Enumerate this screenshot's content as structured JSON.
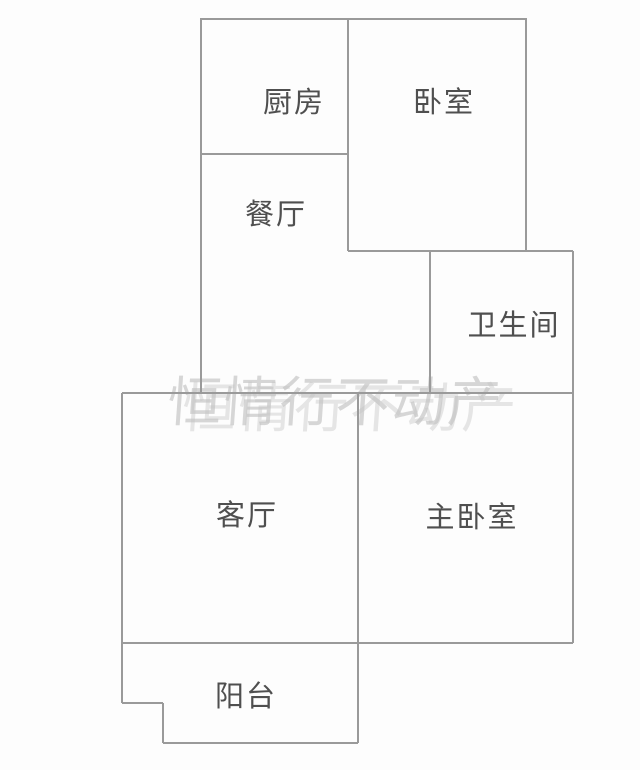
{
  "floorplan": {
    "type": "apartment-floor-plan",
    "background_color": "#fdfdfd",
    "wall_color": "#9a9a9a",
    "label_color": "#4f4f4f",
    "watermark": {
      "text": "恒情行不动产",
      "color": "#c1c1c1"
    },
    "rooms": [
      {
        "id": "kitchen",
        "label": "厨房"
      },
      {
        "id": "bedroom",
        "label": "卧室"
      },
      {
        "id": "dining-room",
        "label": "餐厅"
      },
      {
        "id": "bathroom",
        "label": "卫生间"
      },
      {
        "id": "living-room",
        "label": "客厅"
      },
      {
        "id": "master-bedroom",
        "label": "主卧室"
      },
      {
        "id": "balcony",
        "label": "阳台"
      }
    ]
  }
}
